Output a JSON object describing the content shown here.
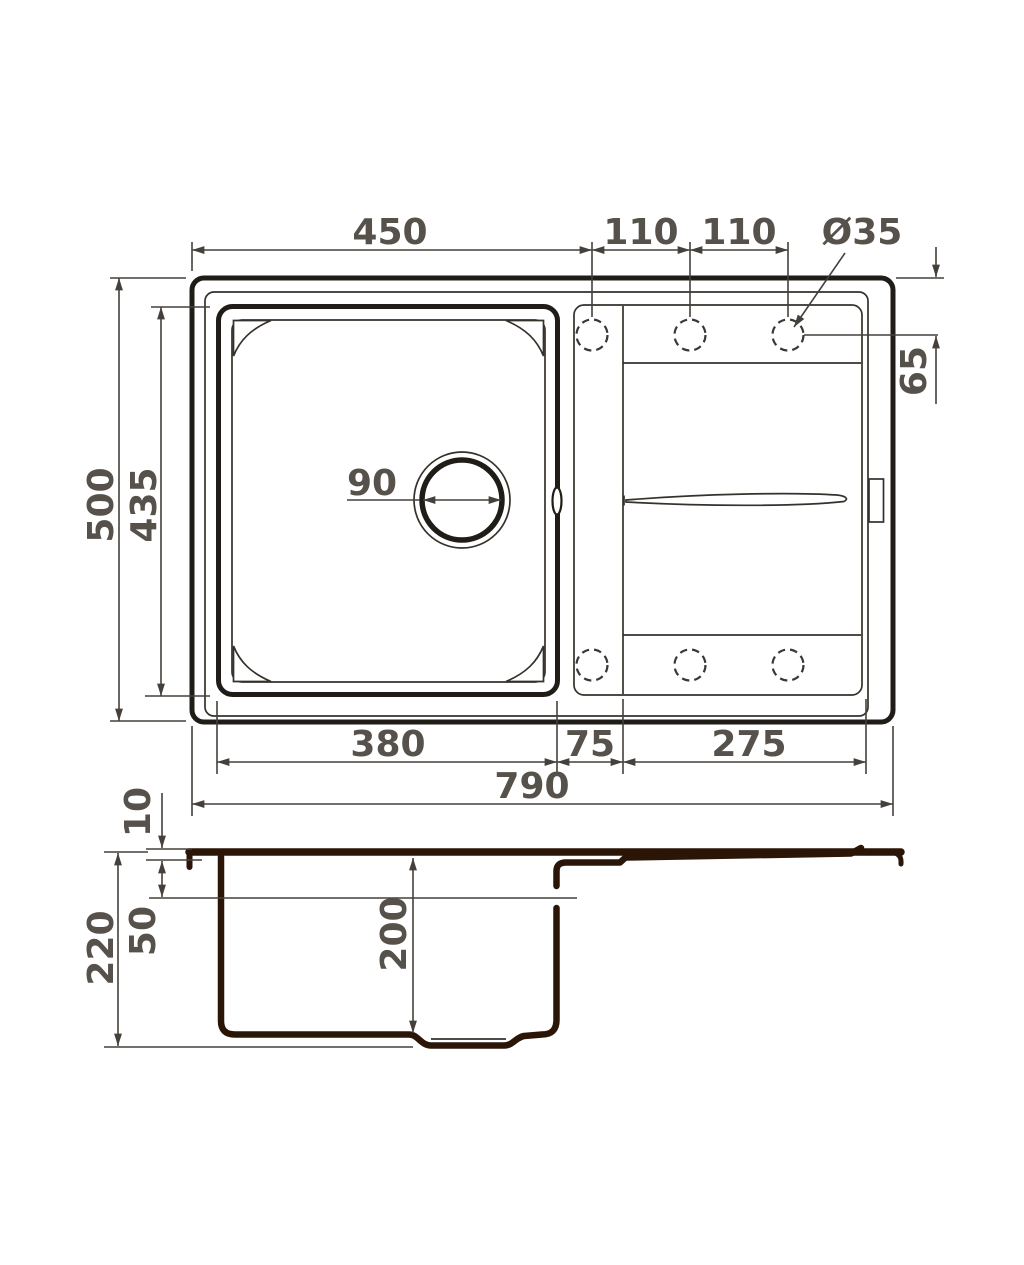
{
  "drawing_type": "kitchen-sink-technical-drawing",
  "dims": {
    "top": {
      "bowl_width": "450",
      "hole_pitch_1": "110",
      "hole_pitch_2": "110",
      "hole_diameter": "Ø35",
      "hole_offset_y": "65",
      "overall_depth": "500",
      "bowl_depth": "435",
      "drain_diameter": "90",
      "bowl_bottom_width": "380",
      "ledge_width": "75",
      "drainboard_width": "275",
      "overall_width": "790"
    },
    "side": {
      "rim_height": "10",
      "deck_depth": "50",
      "overall_height": "220",
      "bowl_height": "200"
    }
  },
  "colors": {
    "outline": "#201c17",
    "profile": "#2a1507",
    "dimension_line": "#45403b",
    "label_text": "#56514b",
    "background": "#ffffff"
  }
}
